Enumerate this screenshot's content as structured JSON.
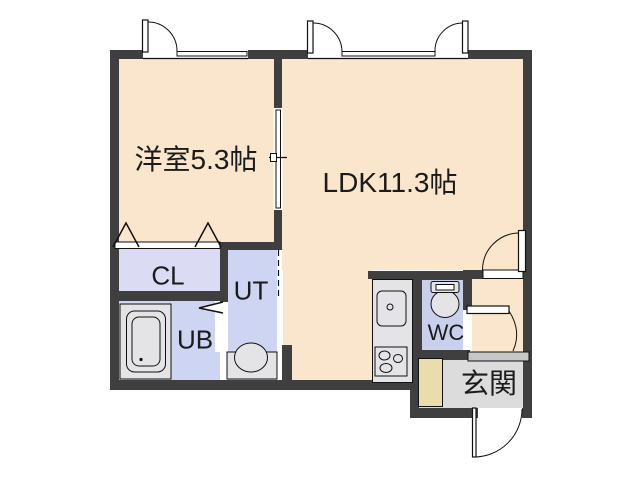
{
  "plan": {
    "title": "apartment-floor-plan",
    "rooms": [
      {
        "id": "youshitsu",
        "label": "洋室5.3帖"
      },
      {
        "id": "ldk",
        "label": "LDK11.3帖"
      },
      {
        "id": "cl",
        "label": "CL"
      },
      {
        "id": "ut",
        "label": "UT"
      },
      {
        "id": "ub",
        "label": "UB"
      },
      {
        "id": "wc",
        "label": "WC"
      },
      {
        "id": "genkan",
        "label": "玄関"
      }
    ],
    "colors": {
      "bg": "#FFFFFF",
      "wall": "#3F3F3F",
      "line": "#111111",
      "floor": "#FAE6CC",
      "closet": "#DBDBF3",
      "bath": "#CDD5F2",
      "wcfill": "#C9D0EC",
      "genkan": "#DCDCDC",
      "step": "#C6C6C6",
      "cabinet": "#EBDCAD",
      "fixture": "#E4E4E6"
    }
  }
}
